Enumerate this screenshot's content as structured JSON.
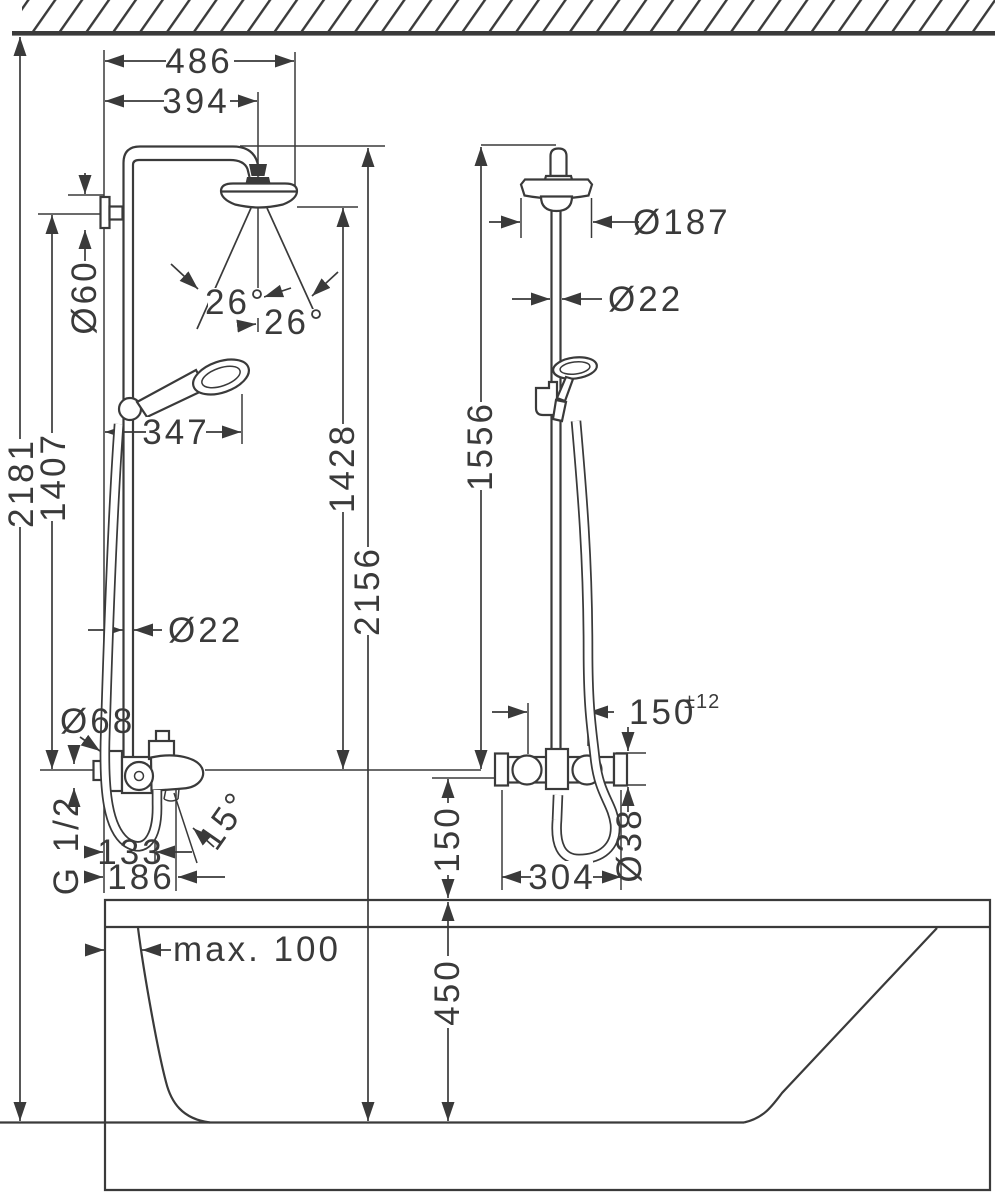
{
  "colors": {
    "ink": "#3a3a3a"
  },
  "front_view": {
    "dim_486": "486",
    "dim_394": "394",
    "dia_60": "Ø60",
    "dim_2181": "2181",
    "dim_1407": "1407",
    "angle_26_upper": "26°",
    "angle_26_lower": "26°",
    "dim_347": "347",
    "dia_22": "Ø22",
    "dim_1428": "1428",
    "dim_2156": "2156",
    "dia_68": "Ø68",
    "thread_g12": "G 1/2",
    "dim_133": "133",
    "dim_186": "186",
    "angle_15": "15°"
  },
  "side_view": {
    "dia_187": "Ø187",
    "dia_22": "Ø22",
    "dim_1556": "1556",
    "dim_150_offset": "150",
    "tolerance": "±12",
    "dia_38": "Ø38",
    "dim_304": "304",
    "dim_150_height": "150"
  },
  "bathtub": {
    "max_depth": "max. 100",
    "dim_450": "450"
  }
}
